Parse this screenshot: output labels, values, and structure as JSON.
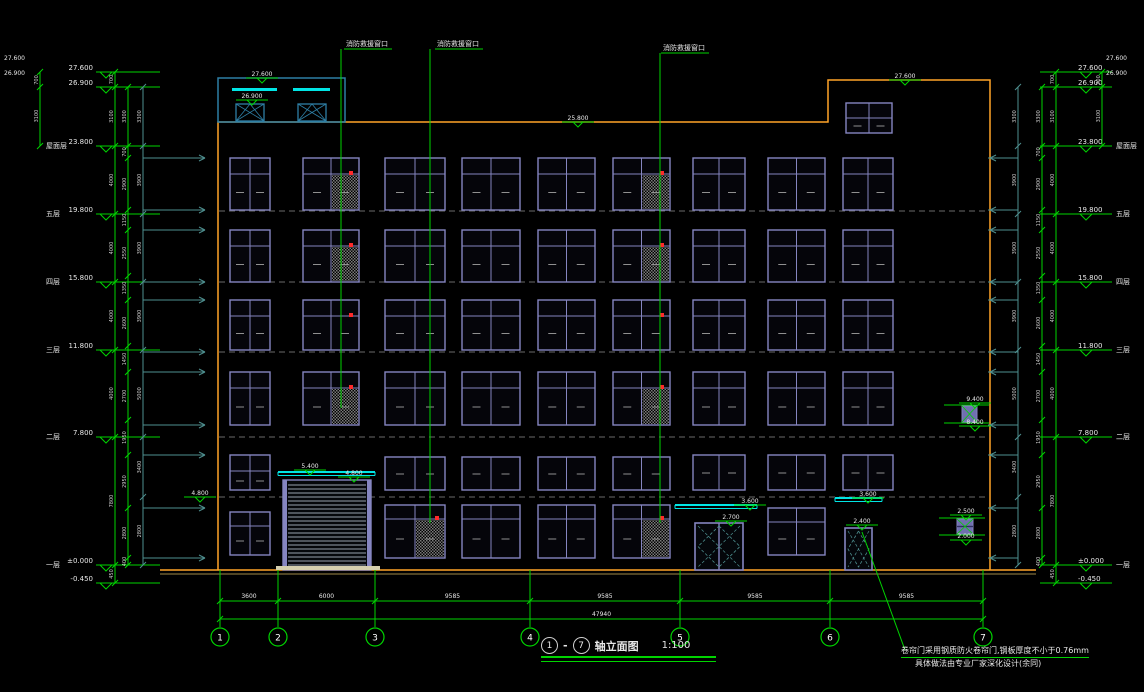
{
  "title_block": {
    "axis_from": "1",
    "separator": "-",
    "axis_to": "7",
    "name": "轴立面图",
    "scale": "1:100"
  },
  "note": {
    "line1": "卷帘门采用钢质防火卷帘门,钢板厚度不小于0.76mm",
    "line2": "具体做法由专业厂家深化设计(余同)"
  },
  "annotations": [
    {
      "label": "消防救援窗口",
      "tx": 346,
      "ty": 46,
      "lx": 341,
      "y2": 408
    },
    {
      "label": "消防救援窗口",
      "tx": 437,
      "ty": 46,
      "lx": 430,
      "y2": 523
    },
    {
      "label": "消防救援窗口",
      "tx": 663,
      "ty": 50,
      "lx": 660,
      "y2": 523
    }
  ],
  "levels": {
    "left": [
      {
        "y": 72,
        "v": "27.600"
      },
      {
        "y": 87,
        "v": "26.900"
      },
      {
        "y": 146,
        "v": "23.800",
        "label": "屋面层"
      },
      {
        "y": 214,
        "v": "19.800",
        "label": "五层"
      },
      {
        "y": 282,
        "v": "15.800",
        "label": "四层"
      },
      {
        "y": 350,
        "v": "11.800",
        "label": "三层"
      },
      {
        "y": 437,
        "v": "7.800",
        "label": "二层"
      },
      {
        "y": 565,
        "v": "±0.000",
        "label": "一层"
      },
      {
        "y": 583,
        "v": "-0.450"
      }
    ],
    "right": [
      {
        "y": 72,
        "v": "27.600"
      },
      {
        "y": 87,
        "v": "26.900"
      },
      {
        "y": 146,
        "v": "23.800",
        "label": "屋面层"
      },
      {
        "y": 214,
        "v": "19.800",
        "label": "五层"
      },
      {
        "y": 282,
        "v": "15.800",
        "label": "四层"
      },
      {
        "y": 350,
        "v": "11.800",
        "label": "三层"
      },
      {
        "y": 437,
        "v": "7.800",
        "label": "二层"
      },
      {
        "y": 565,
        "v": "±0.000",
        "label": "一层"
      },
      {
        "y": 583,
        "v": "-0.450"
      }
    ],
    "corner_left": [
      {
        "x": 4,
        "y": 60,
        "v": "27.600"
      },
      {
        "x": 4,
        "y": 75,
        "v": "26.900"
      }
    ],
    "corner_right": [
      {
        "x": 1106,
        "y": 60,
        "v": "27.600"
      },
      {
        "x": 1106,
        "y": 75,
        "v": "26.900"
      }
    ]
  },
  "feature_marks": [
    {
      "x": 262,
      "y": 78,
      "v": "27.600"
    },
    {
      "x": 252,
      "y": 100,
      "v": "26.900"
    },
    {
      "x": 578,
      "y": 122,
      "v": "25.800"
    },
    {
      "x": 905,
      "y": 80,
      "v": "27.600"
    },
    {
      "x": 310,
      "y": 470,
      "v": "5.400"
    },
    {
      "x": 354,
      "y": 477,
      "v": "4.800"
    },
    {
      "x": 750,
      "y": 505,
      "v": "3.600"
    },
    {
      "x": 731,
      "y": 521,
      "v": "2.700"
    },
    {
      "x": 868,
      "y": 498,
      "v": "3.600"
    },
    {
      "x": 862,
      "y": 525,
      "v": "2.400"
    },
    {
      "x": 975,
      "y": 403,
      "v": "9.400"
    },
    {
      "x": 975,
      "y": 426,
      "v": "8.400"
    },
    {
      "x": 966,
      "y": 515,
      "v": "2.500"
    },
    {
      "x": 966,
      "y": 540,
      "v": "2.000"
    },
    {
      "x": 200,
      "y": 497,
      "v": "4.800"
    }
  ],
  "axis_grid": {
    "bubbles": [
      {
        "x": 220,
        "n": "1"
      },
      {
        "x": 278,
        "n": "2"
      },
      {
        "x": 375,
        "n": "3"
      },
      {
        "x": 530,
        "n": "4"
      },
      {
        "x": 680,
        "n": "5"
      },
      {
        "x": 830,
        "n": "6"
      },
      {
        "x": 983,
        "n": "7"
      }
    ],
    "segments": [
      "3600",
      "6000",
      "9585",
      "9585",
      "9585",
      "9585"
    ],
    "total": "47940",
    "dim_y": 601,
    "total_y": 619,
    "bubble_y": 637
  },
  "dims": {
    "left_chainA": {
      "x": 115,
      "ticks": [
        72,
        87,
        146,
        214,
        282,
        350,
        437,
        565,
        583
      ],
      "vals": [
        "700",
        "3100",
        "4000",
        "4000",
        "4000",
        "4000",
        "7800",
        "450"
      ]
    },
    "left_chainB": {
      "x": 128,
      "ticks": [
        87,
        146,
        158,
        210,
        230,
        276,
        300,
        346,
        372,
        420,
        455,
        508,
        558,
        565
      ],
      "vals": [
        "3300",
        "700",
        "2900",
        "1150",
        "2550",
        "1350",
        "2600",
        "1450",
        "2700",
        "1950",
        "2950",
        "2800",
        "400"
      ]
    },
    "left_teal": {
      "x": 143,
      "ticks": [
        87,
        146,
        214,
        282,
        350,
        437,
        497,
        565
      ],
      "vals": [
        "3300",
        "3900",
        "3900",
        "3900",
        "5000",
        "3400",
        "2800"
      ]
    },
    "right_teal": {
      "x": 1018,
      "ticks": [
        87,
        146,
        214,
        282,
        350,
        437,
        497,
        565
      ],
      "vals": [
        "3300",
        "3900",
        "3900",
        "3900",
        "5000",
        "3400",
        "2800"
      ]
    },
    "right_chainB": {
      "x": 1042,
      "ticks": [
        87,
        146,
        158,
        210,
        230,
        276,
        300,
        346,
        372,
        420,
        455,
        508,
        558,
        565
      ],
      "vals": [
        "3300",
        "700",
        "2900",
        "1150",
        "2550",
        "1350",
        "2600",
        "1450",
        "2700",
        "1950",
        "2950",
        "2800",
        "400"
      ]
    },
    "right_chainA": {
      "x": 1056,
      "ticks": [
        72,
        87,
        146,
        214,
        282,
        350,
        437,
        565,
        583
      ],
      "vals": [
        "700",
        "3100",
        "4000",
        "4000",
        "4000",
        "4000",
        "7800",
        "450"
      ]
    },
    "teal_arrow_ys": [
      158,
      210,
      230,
      282,
      300,
      352,
      372,
      425,
      455,
      508,
      558
    ],
    "mini_left_x": 40,
    "mini_right_x": 1102,
    "mini_vals": [
      "700",
      "3100"
    ]
  },
  "geometry": {
    "ground_y": 570,
    "slab_ys": [
      211,
      282,
      352,
      437,
      497
    ],
    "outline": "M218 570 L218 122 L828 122 L828 80 L990 80 L990 570",
    "parapet_y": 122,
    "roof_structure": {
      "x": 218,
      "y": 78,
      "w": 127,
      "h": 44,
      "bars": [
        [
          232,
          88,
          45
        ],
        [
          293,
          88,
          37
        ]
      ],
      "louvers": [
        [
          236,
          104,
          28,
          17
        ],
        [
          298,
          104,
          28,
          17
        ]
      ]
    },
    "penthouse_window": {
      "x": 846,
      "y": 103,
      "w": 46,
      "h": 30
    },
    "cols": [
      {
        "x": 230,
        "w": 40
      },
      {
        "x": 303,
        "w": 56
      },
      {
        "x": 385,
        "w": 60
      },
      {
        "x": 462,
        "w": 58
      },
      {
        "x": 538,
        "w": 57
      },
      {
        "x": 613,
        "w": 57
      },
      {
        "x": 693,
        "w": 52
      },
      {
        "x": 768,
        "w": 57
      },
      {
        "x": 843,
        "w": 50
      }
    ],
    "rows": [
      {
        "y": 158,
        "h": 52
      },
      {
        "y": 230,
        "h": 52
      },
      {
        "y": 300,
        "h": 50
      },
      {
        "y": 372,
        "h": 53
      }
    ],
    "hatch_cells": [
      [
        0,
        1
      ],
      [
        1,
        1
      ],
      [
        3,
        1
      ],
      [
        0,
        5
      ],
      [
        1,
        5
      ],
      [
        3,
        5
      ]
    ],
    "dot_cells": [
      [
        2,
        1
      ],
      [
        2,
        5
      ]
    ],
    "ground_windows": [
      {
        "x": 230,
        "w": 40,
        "y": 455,
        "h": 35,
        "t": 16
      },
      {
        "x": 230,
        "w": 40,
        "y": 512,
        "h": 43,
        "t": 14
      },
      {
        "x": 385,
        "w": 60,
        "y": 457,
        "h": 33,
        "t": 0
      },
      {
        "x": 462,
        "w": 58,
        "y": 457,
        "h": 33,
        "t": 0
      },
      {
        "x": 538,
        "w": 57,
        "y": 457,
        "h": 33,
        "t": 0
      },
      {
        "x": 613,
        "w": 57,
        "y": 457,
        "h": 33,
        "t": 0
      },
      {
        "x": 693,
        "w": 52,
        "y": 455,
        "h": 35,
        "t": 0
      },
      {
        "x": 768,
        "w": 57,
        "y": 455,
        "h": 35,
        "t": 0
      },
      {
        "x": 843,
        "w": 50,
        "y": 455,
        "h": 35,
        "t": 0
      },
      {
        "x": 385,
        "w": 60,
        "y": 505,
        "h": 53,
        "t": 14,
        "hatch": true
      },
      {
        "x": 462,
        "w": 58,
        "y": 505,
        "h": 53,
        "t": 14
      },
      {
        "x": 538,
        "w": 57,
        "y": 505,
        "h": 53,
        "t": 14
      },
      {
        "x": 613,
        "w": 57,
        "y": 505,
        "h": 53,
        "t": 14,
        "hatch": true
      },
      {
        "x": 768,
        "w": 57,
        "y": 508,
        "h": 47,
        "t": 14
      }
    ],
    "roller_door": {
      "x": 283,
      "y": 480,
      "w": 88,
      "h": 90
    },
    "doors": [
      {
        "x": 695,
        "y": 523,
        "w": 48,
        "h": 47,
        "double": true
      },
      {
        "x": 845,
        "y": 528,
        "w": 27,
        "h": 42,
        "double": false
      }
    ],
    "canopies": [
      {
        "x1": 278,
        "x2": 375,
        "y": 472
      },
      {
        "x1": 675,
        "x2": 757,
        "y": 505
      },
      {
        "x1": 835,
        "x2": 882,
        "y": 498
      }
    ],
    "vents": [
      {
        "x": 962,
        "y": 406,
        "w": 15,
        "h": 16
      },
      {
        "x": 957,
        "y": 519,
        "w": 16,
        "h": 15,
        "mid": true
      }
    ],
    "note_leader": {
      "x1": 905,
      "y1": 650,
      "x2": 862,
      "y2": 532
    }
  },
  "colors": {
    "green": "#00d400",
    "orange": "#ffa428",
    "frame": "#8585c0",
    "steel": "#2e7fa5",
    "cyan": "#00e5e5",
    "teal": "#4e8f8f",
    "slab": "#6a6a6a",
    "tag": "#909090",
    "stripe": "#97a0ae",
    "red": "#ff2a2a",
    "white": "#e8e8e8",
    "apron": "#d5cfae",
    "ground2": "#a08a48"
  }
}
